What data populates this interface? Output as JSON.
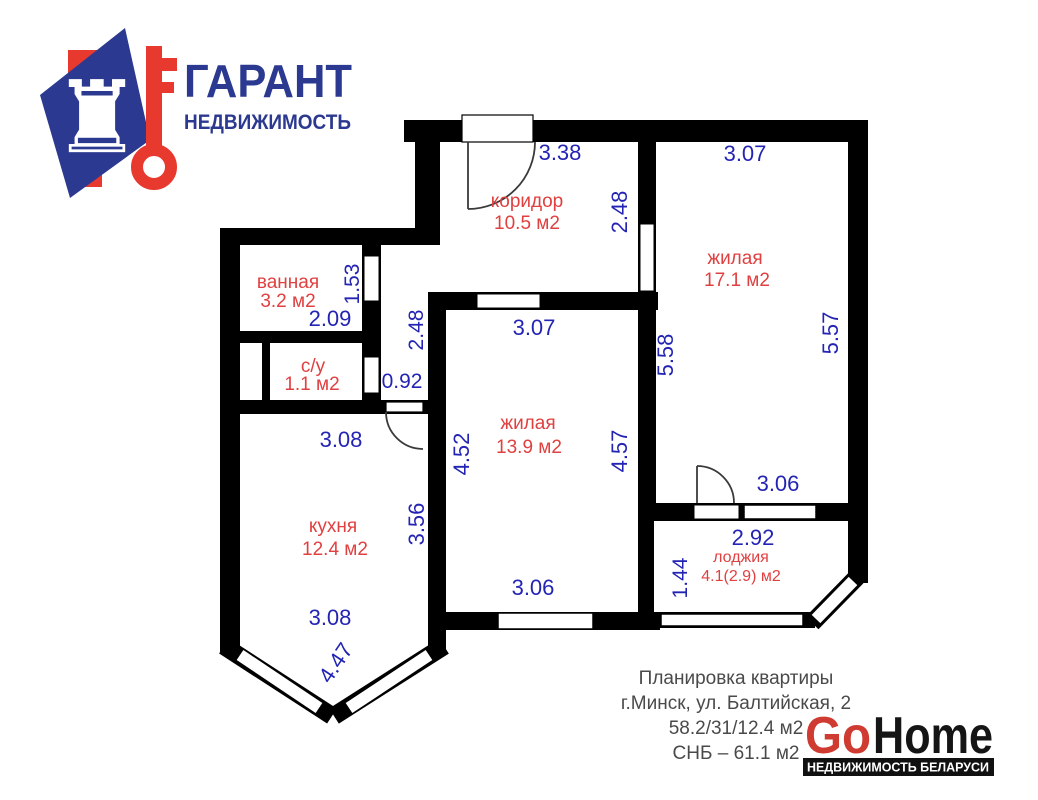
{
  "garant_logo": {
    "title": "ГАРАНТ",
    "subtitle": "НЕДВИЖИМОСТЬ",
    "navy": "#2b3990",
    "red": "#e8392f"
  },
  "plan": {
    "wall_color": "#000000",
    "dim_color": "#2424b4",
    "room_color": "#e04040",
    "rooms": {
      "koridor": {
        "name": "коридор",
        "area": "10.5 м2"
      },
      "zhilaya_17": {
        "name": "жилая",
        "area": "17.1 м2"
      },
      "vannaya": {
        "name": "ванная",
        "area": "3.2 м2"
      },
      "su": {
        "name": "с/у",
        "area": "1.1 м2"
      },
      "zhilaya_13": {
        "name": "жилая",
        "area": "13.9 м2"
      },
      "kuhnya": {
        "name": "кухня",
        "area": "12.4 м2"
      },
      "lodzhiya": {
        "name": "лоджия",
        "area": "4.1(2.9) м2"
      }
    },
    "dims": {
      "koridor_top": "3.38",
      "koridor_right": "2.48",
      "zhilaya17_top": "3.07",
      "zhilaya17_left": "5.58",
      "zhilaya17_right": "5.57",
      "vannaya_door": "1.53",
      "vannaya_bottom": "2.09",
      "hall_height": "2.48",
      "hall_width": "0.92",
      "zhilaya13_top": "3.07",
      "zhilaya13_left": "4.52",
      "zhilaya13_right": "4.57",
      "zhilaya13_bottom": "3.06",
      "kuhnya_top": "3.08",
      "kuhnya_right": "3.56",
      "kuhnya_bottom": "3.08",
      "kuhnya_bay": "4.47",
      "zhilaya17_balcony": "3.06",
      "lodzhiya_width": "2.92",
      "lodzhiya_height": "1.44"
    }
  },
  "footer": {
    "caption_lines": [
      "Планировка квартиры",
      "г.Минск, ул. Балтийская, 2",
      "58.2/31/12.4 м2",
      "СНБ – 61.1 м2"
    ],
    "gohome": {
      "go": "Go",
      "home": "Home",
      "tagline": "НЕДВИЖИМОСТЬ БЕЛАРУСИ",
      "red": "#cf3a31",
      "black": "#151515"
    }
  }
}
